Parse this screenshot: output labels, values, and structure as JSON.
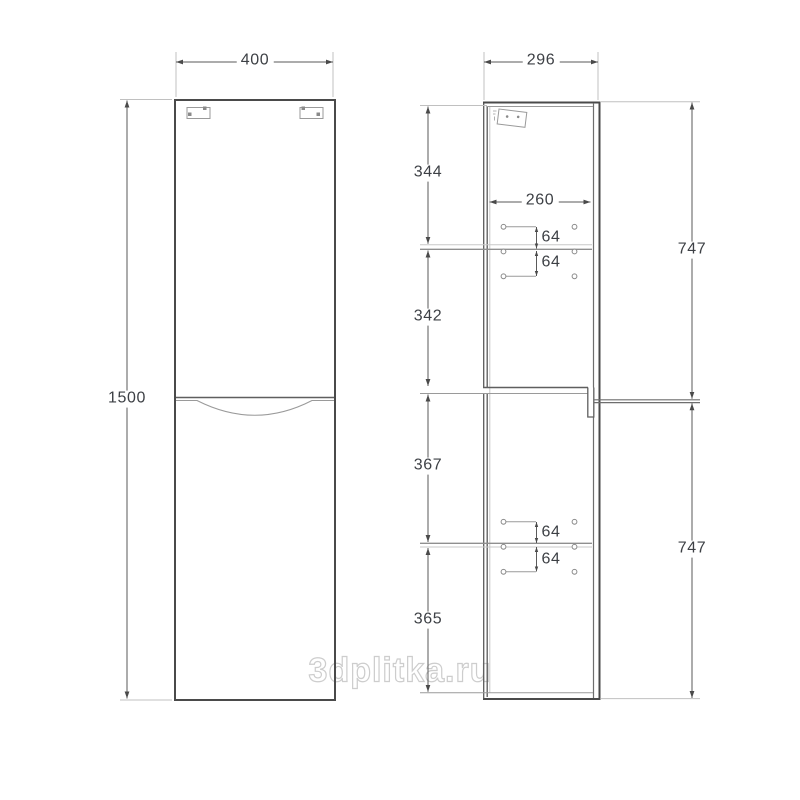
{
  "watermark": "3dplitka.ru",
  "front_view": {
    "width_mm": "400",
    "height_mm": "1500"
  },
  "side_view": {
    "depth_mm": "296",
    "inner_depth_mm": "260",
    "section_heights_mm": [
      "344",
      "342",
      "367",
      "365"
    ],
    "door_heights_mm": [
      "747",
      "747"
    ],
    "pin_spacings_mm": [
      "64",
      "64",
      "64",
      "64"
    ]
  }
}
